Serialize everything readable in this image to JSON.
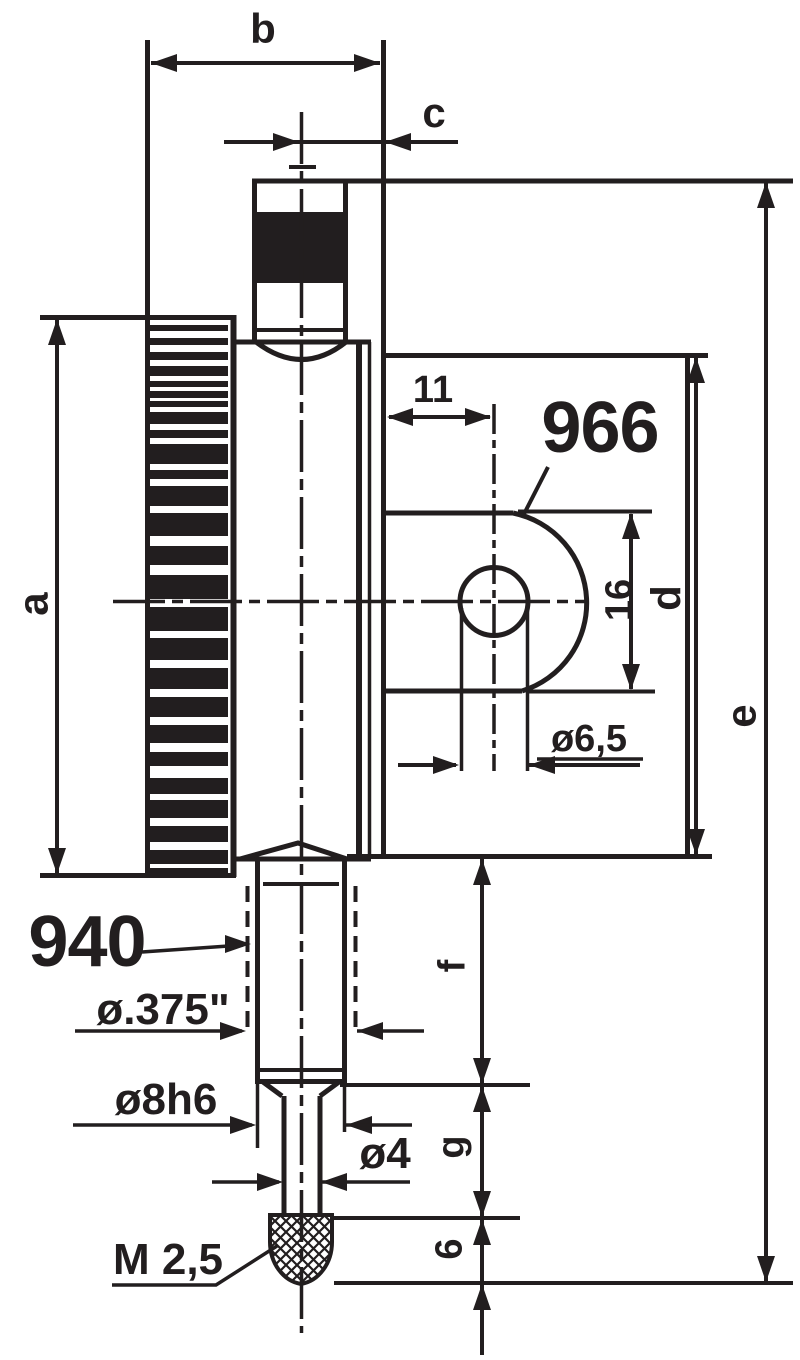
{
  "drawing": {
    "title": "dial-indicator-dimension-drawing",
    "ink_color": "#221e1f",
    "background_color": "#ffffff",
    "dimension_labels": {
      "a": "a",
      "b": "b",
      "c": "c",
      "d": "d",
      "e": "e",
      "f": "f",
      "g": "g",
      "lug_offset": "11",
      "lug_height": "16",
      "lug_hole_dia": "ø6,5",
      "tip_length": "6",
      "stem_dia_inch": "ø.375\"",
      "stem_dia_metric": "ø8h6",
      "spindle_dia": "ø4",
      "tip_thread": "M 2,5"
    },
    "part_numbers": {
      "back_lug": "966",
      "inch_stem_adapter": "940"
    }
  }
}
